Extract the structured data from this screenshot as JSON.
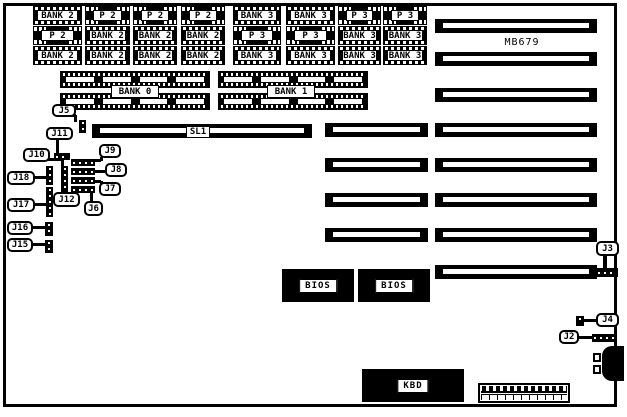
{
  "board": {
    "model_label": "MB679",
    "model_label_pos": [
      500,
      36,
      44,
      12
    ],
    "border": [
      3,
      3,
      614,
      404
    ],
    "colors": {
      "fg": "#000000",
      "bg": "#ffffff"
    }
  },
  "chip_grid": {
    "rows_y": [
      6,
      26,
      46
    ],
    "row_h": 19,
    "cols_x": [
      33,
      85,
      133,
      181,
      233,
      286,
      338,
      383
    ],
    "cols_w": [
      49,
      45,
      44,
      44,
      48,
      49,
      43,
      44
    ],
    "cells": [
      [
        {
          "label": "BANK 2",
          "type": "dip"
        },
        {
          "label": "P 2",
          "type": "plcc"
        },
        {
          "label": "P 2",
          "type": "plcc"
        },
        {
          "label": "P 2",
          "type": "plcc"
        },
        {
          "label": "BANK 3",
          "type": "dip"
        },
        {
          "label": "BANK 3",
          "type": "dip"
        },
        {
          "label": "P 3",
          "type": "plcc"
        },
        {
          "label": "P 3",
          "type": "plcc"
        }
      ],
      [
        {
          "label": "P 2",
          "type": "plcc"
        },
        {
          "label": "BANK 2",
          "type": "dip"
        },
        {
          "label": "BANK 2",
          "type": "dip"
        },
        {
          "label": "BANK 2",
          "type": "dip"
        },
        {
          "label": "P 3",
          "type": "plcc"
        },
        {
          "label": "P 3",
          "type": "plcc"
        },
        {
          "label": "BANK 3",
          "type": "dip"
        },
        {
          "label": "BANK 3",
          "type": "dip"
        }
      ],
      [
        {
          "label": "BANK 2",
          "type": "dip"
        },
        {
          "label": "BANK 2",
          "type": "dip"
        },
        {
          "label": "BANK 2",
          "type": "dip"
        },
        {
          "label": "BANK 2",
          "type": "dip"
        },
        {
          "label": "BANK 3",
          "type": "dip"
        },
        {
          "label": "BANK 3",
          "type": "dip"
        },
        {
          "label": "BANK 3",
          "type": "dip"
        },
        {
          "label": "BANK 3",
          "type": "dip"
        }
      ]
    ]
  },
  "memory_banks": [
    {
      "label": "BANK 0",
      "strips": [
        [
          60,
          71,
          150,
          17
        ],
        [
          60,
          93,
          150,
          17
        ]
      ],
      "label_box": [
        111,
        85,
        48,
        13
      ]
    },
    {
      "label": "BANK 1",
      "strips": [
        [
          218,
          71,
          150,
          17
        ],
        [
          218,
          93,
          150,
          17
        ]
      ],
      "label_box": [
        267,
        85,
        48,
        13
      ]
    }
  ],
  "slots": {
    "sl1": {
      "label": "SL1",
      "rect": [
        92,
        124,
        220,
        14
      ],
      "label_box": [
        186,
        126,
        24,
        12
      ]
    },
    "middle_column": {
      "x": 325,
      "w": 103,
      "h": 14,
      "ys": [
        123,
        158,
        193,
        228
      ]
    },
    "right_column": {
      "x": 435,
      "w": 162,
      "h": 14,
      "ys": [
        19,
        52,
        88,
        123,
        158,
        193,
        228,
        265
      ]
    }
  },
  "ics": [
    {
      "label": "BIOS",
      "rect": [
        282,
        269,
        72,
        33
      ]
    },
    {
      "label": "BIOS",
      "rect": [
        358,
        269,
        72,
        33
      ]
    },
    {
      "label": "KBD",
      "rect": [
        362,
        369,
        102,
        33
      ]
    }
  ],
  "connectors": {
    "bottom_header": {
      "rect": [
        478,
        383,
        92,
        20
      ],
      "pin_count": 12
    },
    "keyboard_din": {
      "body": [
        602,
        346,
        22,
        35
      ],
      "pins": [
        [
          593,
          353
        ],
        [
          593,
          365
        ]
      ]
    }
  },
  "jumpers": {
    "blocks": [
      {
        "id": "j5-block",
        "rect": [
          79,
          120,
          7,
          13
        ],
        "orient": "v"
      },
      {
        "id": "j11-block",
        "rect": [
          54,
          153,
          16,
          7
        ],
        "orient": "h"
      },
      {
        "id": "j18-block",
        "rect": [
          46,
          166,
          7,
          19
        ],
        "orient": "v"
      },
      {
        "id": "j17-block",
        "rect": [
          46,
          187,
          7,
          30
        ],
        "orient": "v"
      },
      {
        "id": "j10-j12-block",
        "rect": [
          61,
          166,
          7,
          29
        ],
        "orient": "v"
      },
      {
        "id": "j9-block",
        "rect": [
          71,
          159,
          24,
          7
        ],
        "orient": "h"
      },
      {
        "id": "j8-block",
        "rect": [
          71,
          168,
          24,
          7
        ],
        "orient": "h"
      },
      {
        "id": "j7-block",
        "rect": [
          71,
          177,
          24,
          7
        ],
        "orient": "h"
      },
      {
        "id": "j6-block",
        "rect": [
          71,
          186,
          24,
          7
        ],
        "orient": "h"
      },
      {
        "id": "j16-block",
        "rect": [
          45,
          222,
          8,
          14
        ],
        "orient": "v"
      },
      {
        "id": "j15-block",
        "rect": [
          45,
          240,
          8,
          13
        ],
        "orient": "v"
      },
      {
        "id": "j3-block",
        "rect": [
          596,
          268,
          22,
          9
        ],
        "orient": "h"
      },
      {
        "id": "j4-block",
        "rect": [
          576,
          316,
          8,
          10
        ],
        "orient": "v"
      },
      {
        "id": "j2-block",
        "rect": [
          592,
          334,
          25,
          8
        ],
        "orient": "h"
      }
    ],
    "callouts": [
      {
        "label": "J5",
        "box": [
          52,
          104,
          24,
          13
        ],
        "tails": [
          [
            68,
            114,
            8,
            3
          ],
          [
            74,
            115,
            3,
            7
          ]
        ]
      },
      {
        "label": "J11",
        "box": [
          46,
          127,
          27,
          13
        ],
        "tails": [
          [
            56,
            139,
            3,
            14
          ]
        ]
      },
      {
        "label": "J10",
        "box": [
          23,
          148,
          27,
          14
        ],
        "tails": [
          [
            47,
            158,
            15,
            3
          ],
          [
            61,
            158,
            3,
            8
          ]
        ]
      },
      {
        "label": "J9",
        "box": [
          99,
          144,
          22,
          14
        ],
        "tails": [
          [
            100,
            157,
            3,
            4
          ],
          [
            94,
            159,
            7,
            3
          ]
        ]
      },
      {
        "label": "J8",
        "box": [
          105,
          163,
          22,
          14
        ],
        "tails": [
          [
            95,
            170,
            10,
            3
          ]
        ]
      },
      {
        "label": "J7",
        "box": [
          99,
          182,
          22,
          14
        ],
        "tails": [
          [
            94,
            180,
            7,
            3
          ],
          [
            100,
            181,
            3,
            4
          ]
        ]
      },
      {
        "label": "J6",
        "box": [
          84,
          201,
          19,
          15
        ],
        "tails": [
          [
            90,
            191,
            3,
            10
          ]
        ]
      },
      {
        "label": "J12",
        "box": [
          53,
          192,
          27,
          15
        ],
        "tails": [
          [
            64,
            188,
            3,
            5
          ]
        ]
      },
      {
        "label": "J18",
        "box": [
          7,
          171,
          28,
          14
        ],
        "tails": [
          [
            34,
            176,
            12,
            3
          ]
        ]
      },
      {
        "label": "J17",
        "box": [
          7,
          198,
          28,
          14
        ],
        "tails": [
          [
            34,
            203,
            12,
            3
          ]
        ]
      },
      {
        "label": "J16",
        "box": [
          7,
          221,
          26,
          14
        ],
        "tails": [
          [
            32,
            226,
            13,
            3
          ]
        ]
      },
      {
        "label": "J15",
        "box": [
          7,
          238,
          26,
          14
        ],
        "tails": [
          [
            32,
            243,
            13,
            3
          ]
        ]
      },
      {
        "label": "J3",
        "box": [
          596,
          241,
          23,
          15
        ],
        "tails": [
          [
            603,
            255,
            4,
            13
          ]
        ]
      },
      {
        "label": "J4",
        "box": [
          596,
          313,
          23,
          14
        ],
        "tails": [
          [
            584,
            319,
            12,
            3
          ]
        ]
      },
      {
        "label": "J2",
        "box": [
          559,
          330,
          20,
          14
        ],
        "tails": [
          [
            578,
            336,
            14,
            3
          ]
        ]
      }
    ]
  }
}
